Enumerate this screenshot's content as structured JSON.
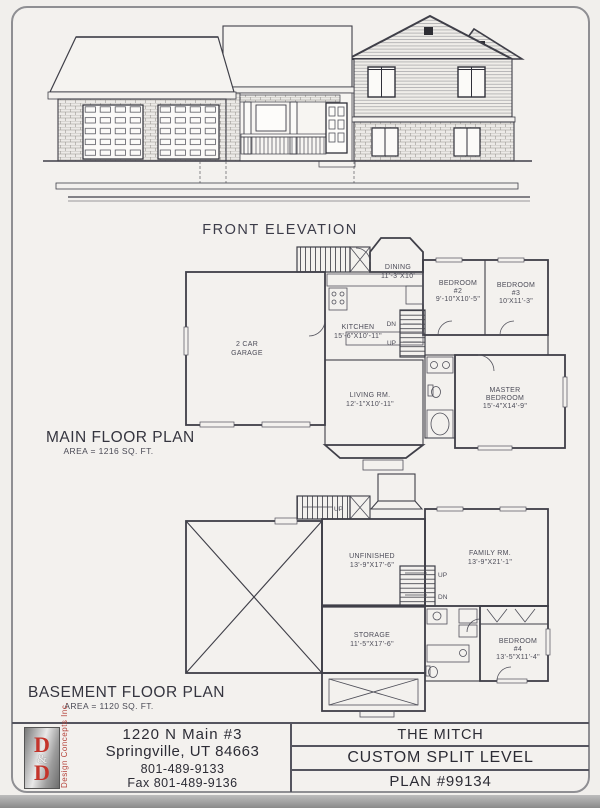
{
  "front_elevation": {
    "label": "FRONT ELEVATION"
  },
  "main_floor": {
    "title": "MAIN FLOOR PLAN",
    "area": "AREA = 1216 SQ. FT.",
    "rooms": {
      "garage": [
        "2 CAR",
        "GARAGE"
      ],
      "kitchen": [
        "KITCHEN",
        "15'-6\"X10'-11\""
      ],
      "dining": [
        "DINING",
        "11'-3\"X10'"
      ],
      "bedroom2": [
        "BEDROOM",
        "#2",
        "9'-10\"X10'-5\""
      ],
      "bedroom3": [
        "BEDROOM",
        "#3",
        "10'X11'-3\""
      ],
      "living": [
        "LIVING RM.",
        "12'-1\"X10'-11\""
      ],
      "master": [
        "MASTER",
        "BEDROOM",
        "15'-4\"X14'-9\""
      ],
      "stairs": {
        "dn": "DN",
        "up": "UP"
      }
    }
  },
  "basement": {
    "title": "BASEMENT FLOOR PLAN",
    "area": "AREA = 1120 SQ. FT.",
    "rooms": {
      "unfinished": [
        "UNFINISHED",
        "13'-9\"X17'-6\""
      ],
      "family": [
        "FAMILY RM.",
        "13'-9\"X21'-1\""
      ],
      "storage": [
        "STORAGE",
        "11'-5\"X17'-6\""
      ],
      "bedroom4": [
        "BEDROOM",
        "#4",
        "13'-5\"X11'-4\""
      ],
      "stairs": {
        "up": "UP",
        "dn": "DN"
      }
    }
  },
  "footer": {
    "logo": {
      "d1": "D",
      "amp": "&",
      "d2": "D",
      "tagline": "Design Concepts Inc."
    },
    "address_line1": "1220 N Main #3",
    "address_line2": "Springville, UT 84663",
    "phone": "801-489-9133",
    "fax": "Fax 801-489-9136",
    "plan_name": "THE MITCH",
    "plan_type": "CUSTOM SPLIT LEVEL",
    "plan_number": "PLAN #99134"
  },
  "colors": {
    "logo_red": "#c4342b",
    "line_ink": "#3f3f48",
    "paper": "#f1efec"
  }
}
